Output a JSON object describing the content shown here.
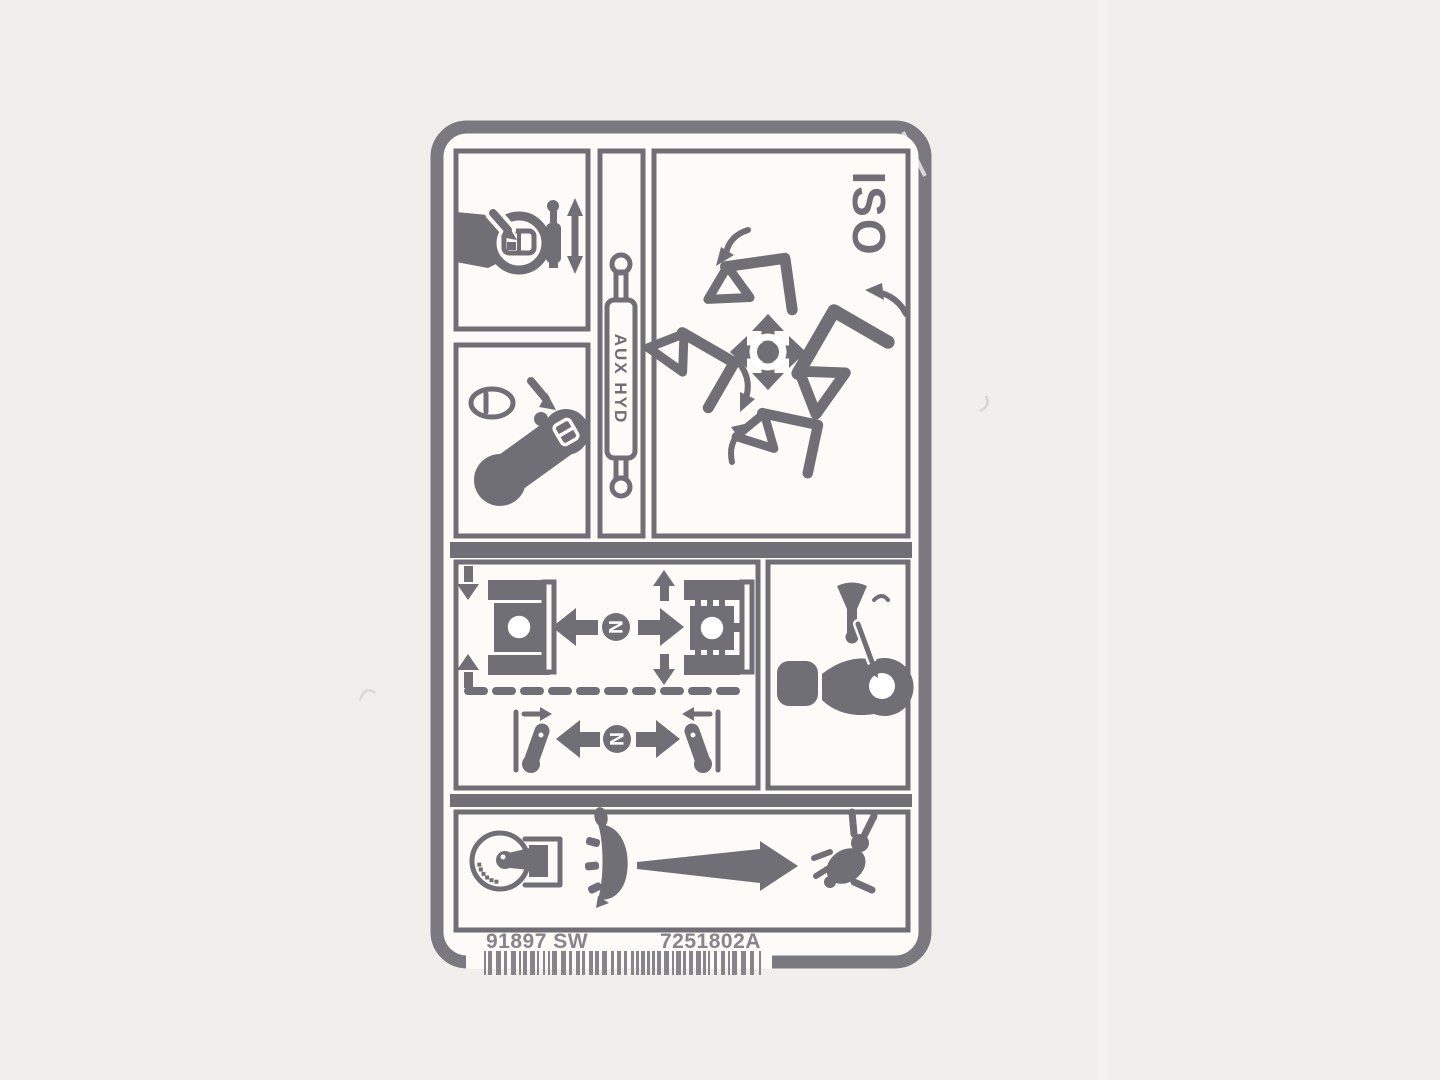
{
  "photo": {
    "background": "#f1efeb"
  },
  "decal": {
    "colors": {
      "ink": "#6f6f75",
      "paper": "#fcfbf8",
      "faint_ink": "#85858b",
      "border": "#7a797f"
    },
    "pattern": "ISO",
    "aux_hyd_label": "AUX HYD",
    "travel_neutral": "N",
    "steer_neutral": "N",
    "footer": {
      "part_left": "91897 SW",
      "part_right": "7251802A"
    },
    "icons": [
      "grip-rocker-switch-icon",
      "proportional-cylinder-icon",
      "double-arrow-icon",
      "detent-button-icon",
      "joystick-handle-icon",
      "aux-hydraulic-cylinder-icon",
      "joystick-cross-arrows-icon",
      "loader-arm-icon-top",
      "loader-arm-icon-left",
      "loader-arm-icon-right",
      "loader-arm-icon-bottom",
      "machine-top-view-icon-left",
      "machine-top-view-icon-right",
      "steer-lever-icon-left",
      "steer-lever-icon-right",
      "horn-icon",
      "horn-button-lever-icon",
      "throttle-dial-icon",
      "turtle-icon",
      "speed-arrow-icon",
      "rabbit-icon"
    ]
  }
}
